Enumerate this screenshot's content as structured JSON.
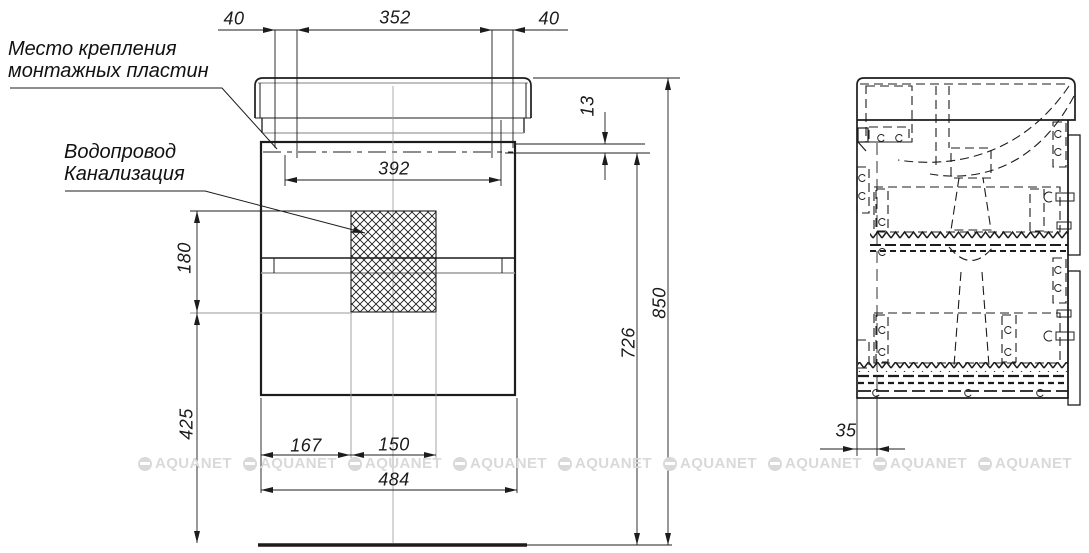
{
  "drawing": {
    "annotations": {
      "mounting_label_line1": "Место крепления",
      "mounting_label_line2": "монтажных пластин",
      "plumbing_label_line1": "Водопровод",
      "plumbing_label_line2": "Канализация"
    },
    "dimensions_mm": {
      "top_left_offset": "40",
      "top_span": "352",
      "top_right_offset": "40",
      "rim_gap": "13",
      "inner_width": "392",
      "hatch_height": "180",
      "body_height": "726",
      "total_height": "850",
      "floor_clearance": "425",
      "hatch_left_offset": "167",
      "hatch_width": "150",
      "cabinet_width": "484",
      "back_panel_offset": "35"
    },
    "watermark_text": "AQUANET"
  }
}
